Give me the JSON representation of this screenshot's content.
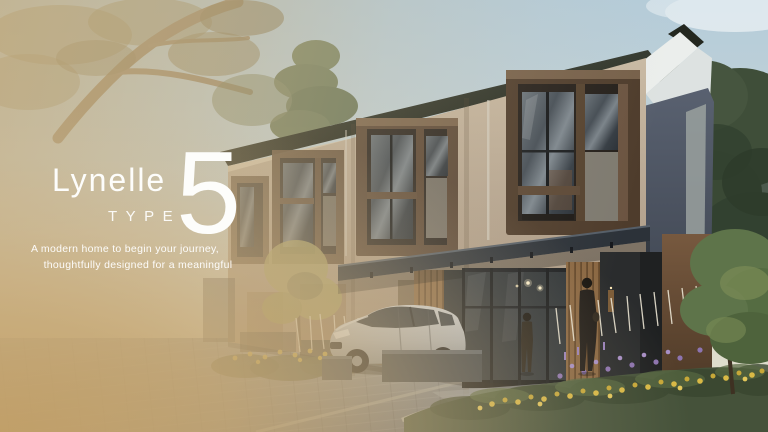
{
  "brand": {
    "name": "Lynelle",
    "type_label": "TYPE",
    "type_number": "5"
  },
  "tagline": {
    "line1": "A modern home to begin your journey,",
    "line2": "thoughtfully designed for a meaningful"
  },
  "scene": {
    "objects": [
      "two-story-townhouse-row",
      "overhanging-tree-branch",
      "pine-trees",
      "silver-hatchback-car",
      "woman-silhouette",
      "child-silhouette",
      "flower-garden-bed",
      "paved-street"
    ],
    "colors": {
      "overlay_tan": "#c7a877",
      "sky": "#bcd2de",
      "roof": "#262b22",
      "wall_beige": "#b3a28e",
      "window_frame_brown": "#52402f",
      "canopy": "#2c3239",
      "hedge_green": "#45523a",
      "flower_yellow": "#d9b945",
      "flower_purple": "#8d74b0",
      "car_silver": "#b7bbbf",
      "text": "#ffffff"
    }
  }
}
